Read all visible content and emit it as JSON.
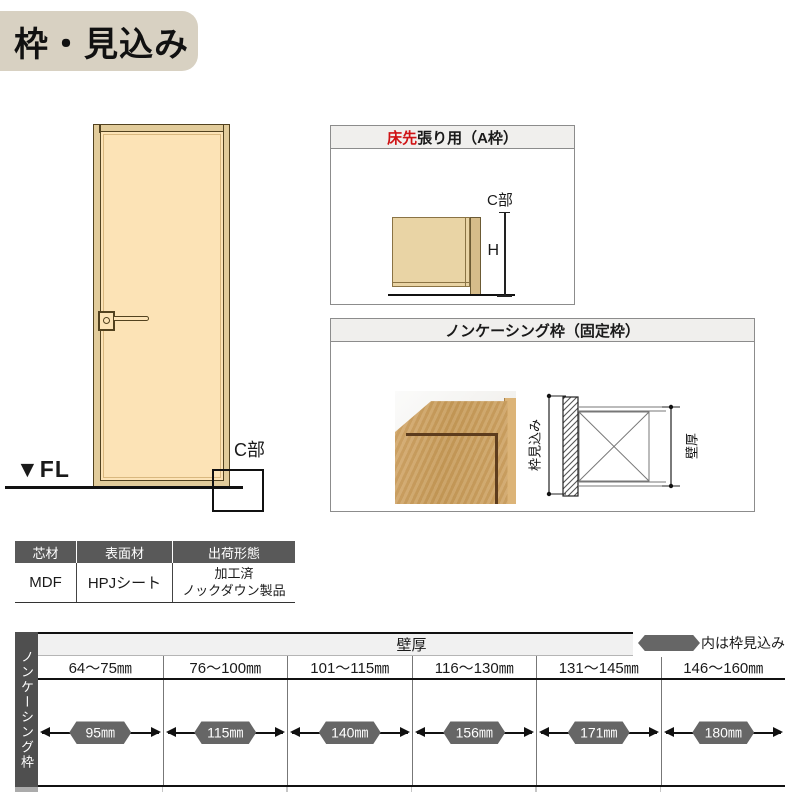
{
  "title": {
    "text": "枠・見込み"
  },
  "door_figure": {
    "fl_label": "▼FL",
    "c_label": "C部"
  },
  "panel_a": {
    "title_highlight": "床先",
    "title_rest": "張り用（A枠）",
    "c_label": "C部",
    "h_label": "H"
  },
  "panel_b": {
    "title": "ノンケーシング枠（固定枠）",
    "frame_depth_label": "枠見込み",
    "wall_thickness_label": "壁厚"
  },
  "spec_table": {
    "headers": [
      "芯材",
      "表面材",
      "出荷形態"
    ],
    "values": [
      "MDF",
      "HPJシート",
      "加工済\nノックダウン製品"
    ]
  },
  "size_table": {
    "row_label": "ノンケーシング枠",
    "header": "壁厚",
    "legend_label": "内は枠見込み",
    "columns": [
      "64～75㎜",
      "76～100㎜",
      "101～115㎜",
      "116～130㎜",
      "131～145㎜",
      "146～160㎜"
    ],
    "values": [
      "95㎜",
      "115㎜",
      "140㎜",
      "156㎜",
      "171㎜",
      "180㎜"
    ]
  },
  "colors": {
    "accent_red": "#cf1315",
    "title_bg": "#d8d1c2",
    "panel_header_bg": "#f0efed",
    "dark_header": "#595959",
    "badge_gray": "#666666",
    "door_face": "#fce3b6",
    "frame_tan": "#e2cc9b"
  }
}
